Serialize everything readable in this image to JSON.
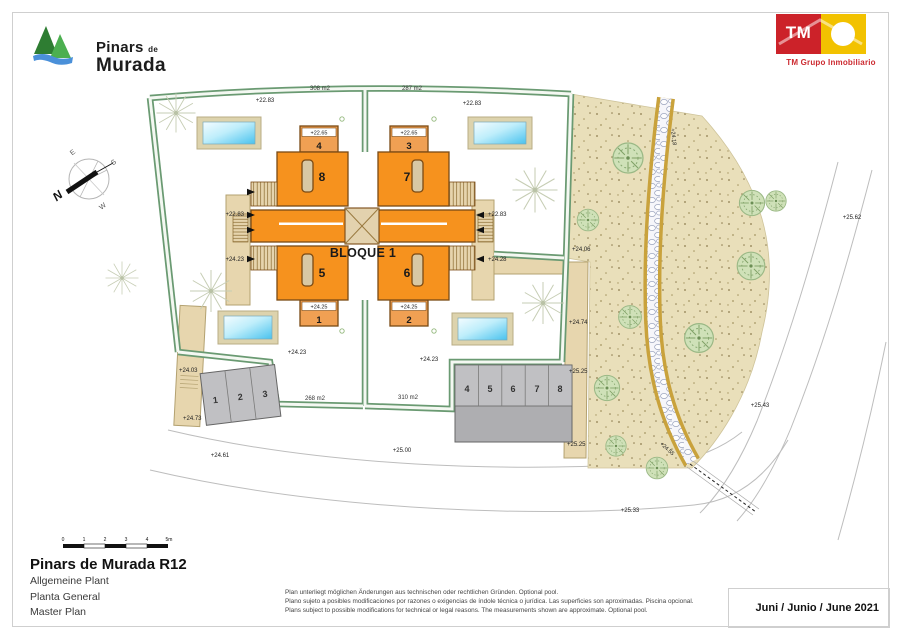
{
  "header": {
    "brand": {
      "line1": "Pinars",
      "de": "de",
      "line2": "Murada"
    },
    "tm": {
      "monogram": "TM",
      "caption": "TM Grupo Inmobiliario"
    }
  },
  "plan": {
    "block_label": "BLOQUE 1",
    "units": {
      "u8": "8",
      "u7": "7",
      "u5": "5",
      "u6": "6"
    },
    "terraces": {
      "t4": {
        "num": "4",
        "elev": "+22.65"
      },
      "t3": {
        "num": "3",
        "elev": "+22.65"
      },
      "t1": {
        "num": "1",
        "elev": "+24.25"
      },
      "t2": {
        "num": "2",
        "elev": "+24.25"
      }
    },
    "areas": {
      "tl": "308 m2",
      "tr": "287 m2",
      "bl": "268 m2",
      "br": "310 m2"
    },
    "garden_elev": {
      "tl": "+22.83",
      "tr": "+22.83",
      "bl": "+24.23",
      "br": "+24.23"
    },
    "entry_elev": {
      "left_upper": "+22.83",
      "left_lower": "+24.23",
      "right_upper": "+22.83",
      "right_lower": "+24.28"
    },
    "side_elev": {
      "e1": "+24.06",
      "e2": "+24.74",
      "e3": "+25.25",
      "e4": "+25.25",
      "w1": "+24.03",
      "w2": "+24.73"
    },
    "road_elev": {
      "r1": "+24.61",
      "r2": "+25.00",
      "r3": "+25.33",
      "r4": "+25.43",
      "r5": "+25.62"
    },
    "path_elev": {
      "p1": "+24.18",
      "p2": "+24.55"
    },
    "parking_left": {
      "p1": "1",
      "p2": "2",
      "p3": "3"
    },
    "parking_right": {
      "p4": "4",
      "p5": "5",
      "p6": "6",
      "p7": "7",
      "p8": "8"
    },
    "compass": {
      "n": "N",
      "e": "E",
      "s": "S",
      "w": "W"
    }
  },
  "scalebar": {
    "t0": "0",
    "t1": "1",
    "t2": "2",
    "t3": "3",
    "t4": "4",
    "t5": "5m"
  },
  "titleblock": {
    "title": "Pinars de Murada R12",
    "lines": {
      "de": "Allgemeine Plant",
      "es": "Planta General",
      "en": "Master Plan"
    }
  },
  "disclaimer": {
    "de": "Plan unterliegt möglichen Änderungen aus technischen oder rechtlichen Gründen. Optional pool.",
    "es": "Plano sujeto a posibles modificaciones por razones o exigencias de índole técnica o jurídica. Las superficies son aproximadas. Piscina opcional.",
    "en": "Plans subject to possible modifications for technical or legal reasons. The measurements shown are approximate. Optional pool."
  },
  "date": "Juni / Junio / June 2021",
  "colors": {
    "building_orange": "#f6921e",
    "terrace_orange": "#f0a053",
    "hedge_green": "#5d8f66",
    "terrain_tan": "#e9dfba",
    "walk_beige": "#e7d6ae",
    "pool_blue": "#49c2ee",
    "parking_gray": "#c0c0c3",
    "tm_red": "#cc2229",
    "tm_yellow": "#f2c200",
    "logo_green": "#3f9447",
    "logo_blue": "#4a90d9"
  }
}
